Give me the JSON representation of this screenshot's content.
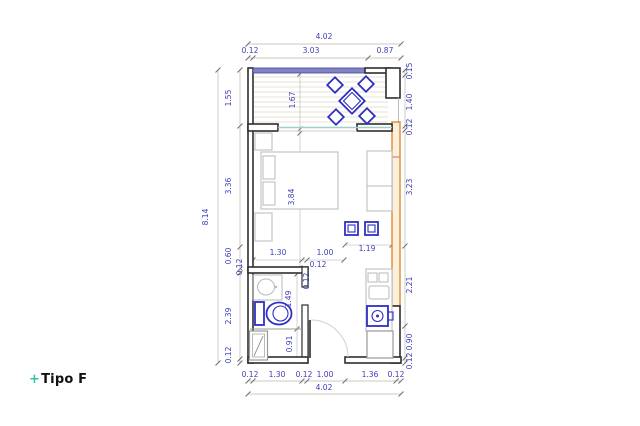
{
  "title": {
    "prefix": "+",
    "label": "Tipo F"
  },
  "colors": {
    "accent_teal": "#35c3a6",
    "dimension_text": "#3c3cba",
    "furniture_blue": "#2f2fc4",
    "wall_black": "#2e2e2e",
    "highlight_wall_orange": "#df8a2e",
    "window_blue": "#8084c2"
  },
  "plan": {
    "overall_width_m": "4.02",
    "overall_height_m": "8.14",
    "furniture_icons": [
      "dining-table-with-chairs",
      "double-bed",
      "nightstand",
      "wardrobe",
      "bar-stool",
      "kitchen-counter",
      "cooktop",
      "kitchen-sink",
      "fridge",
      "washbasin",
      "toilet",
      "shower",
      "entrance-door",
      "sliding-window"
    ],
    "dim_labels": [
      {
        "text": "4.02",
        "x": 324,
        "y": 39,
        "rot": 0
      },
      {
        "text": "0.12",
        "x": 250,
        "y": 53,
        "rot": 0
      },
      {
        "text": "3.03",
        "x": 311,
        "y": 53,
        "rot": 0
      },
      {
        "text": "0.87",
        "x": 385,
        "y": 53,
        "rot": 0
      },
      {
        "text": "8.14",
        "x": 208,
        "y": 217,
        "rot": -90
      },
      {
        "text": "1.55",
        "x": 231,
        "y": 98,
        "rot": -90
      },
      {
        "text": "3.36",
        "x": 231,
        "y": 186,
        "rot": -90
      },
      {
        "text": "0.60",
        "x": 231,
        "y": 256,
        "rot": -90
      },
      {
        "text": "0.12",
        "x": 242,
        "y": 267,
        "rot": -90
      },
      {
        "text": "2.39",
        "x": 231,
        "y": 316,
        "rot": -90
      },
      {
        "text": "0.12",
        "x": 231,
        "y": 355,
        "rot": -90
      },
      {
        "text": "0.15",
        "x": 412,
        "y": 71,
        "rot": -90
      },
      {
        "text": "1.40",
        "x": 412,
        "y": 102,
        "rot": -90
      },
      {
        "text": "0.12",
        "x": 412,
        "y": 127,
        "rot": -90
      },
      {
        "text": "3.23",
        "x": 412,
        "y": 187,
        "rot": -90
      },
      {
        "text": "2.21",
        "x": 412,
        "y": 285,
        "rot": -90
      },
      {
        "text": "0.90",
        "x": 412,
        "y": 342,
        "rot": -90
      },
      {
        "text": "0.12",
        "x": 412,
        "y": 361,
        "rot": -90
      },
      {
        "text": "0.12",
        "x": 250,
        "y": 377,
        "rot": 0
      },
      {
        "text": "1.30",
        "x": 277,
        "y": 377,
        "rot": 0
      },
      {
        "text": "0.12",
        "x": 304,
        "y": 377,
        "rot": 0
      },
      {
        "text": "1.00",
        "x": 325,
        "y": 377,
        "rot": 0
      },
      {
        "text": "1.36",
        "x": 370,
        "y": 377,
        "rot": 0
      },
      {
        "text": "0.12",
        "x": 396,
        "y": 377,
        "rot": 0
      },
      {
        "text": "4.02",
        "x": 324,
        "y": 390,
        "rot": 0
      },
      {
        "text": "1.67",
        "x": 295,
        "y": 100,
        "rot": -90
      },
      {
        "text": "3.84",
        "x": 294,
        "y": 197,
        "rot": -90
      },
      {
        "text": "1.30",
        "x": 278,
        "y": 255,
        "rot": 0
      },
      {
        "text": "1.00",
        "x": 325,
        "y": 255,
        "rot": 0
      },
      {
        "text": "0.12",
        "x": 318,
        "y": 267,
        "rot": 0
      },
      {
        "text": "1.19",
        "x": 367,
        "y": 251,
        "rot": 0
      },
      {
        "text": "0.12",
        "x": 309,
        "y": 281,
        "rot": -90
      },
      {
        "text": "1.49",
        "x": 291,
        "y": 299,
        "rot": -90
      },
      {
        "text": "0.91",
        "x": 292,
        "y": 344,
        "rot": -90
      }
    ]
  }
}
